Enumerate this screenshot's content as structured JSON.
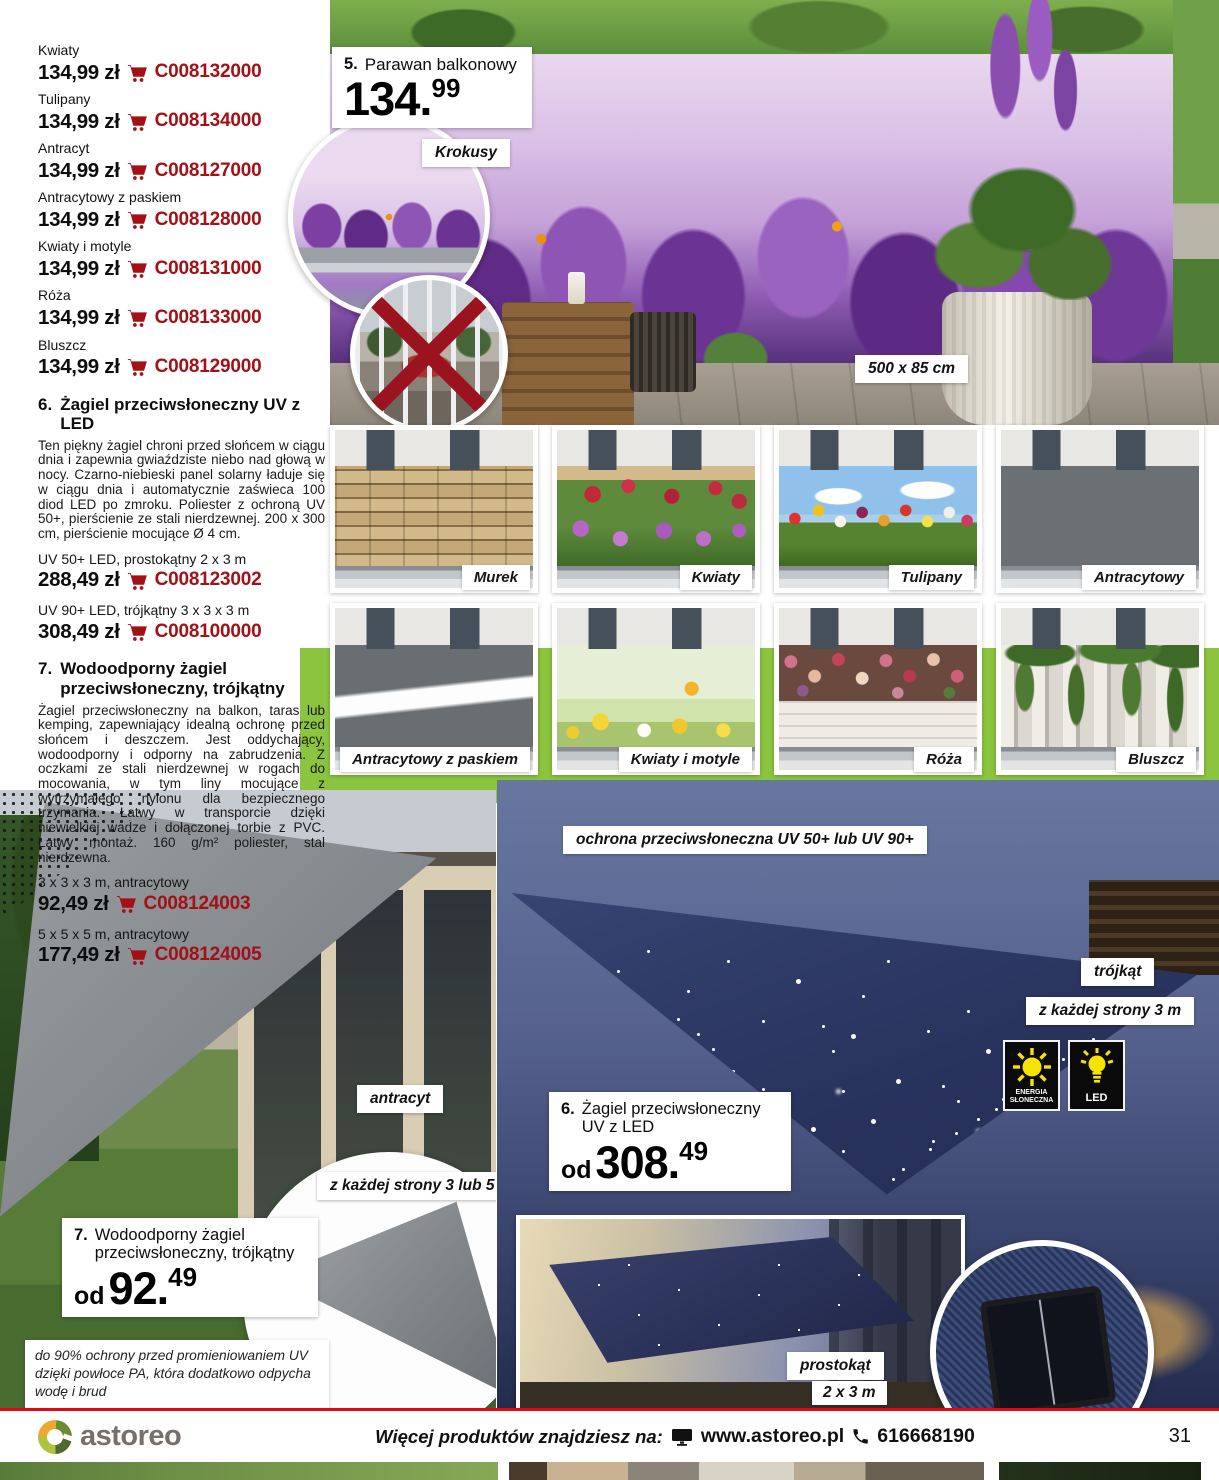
{
  "colors": {
    "accent_red": "#a31016",
    "footer_line": "#e30613",
    "green_band": "#8bc53f"
  },
  "icons": {
    "cart": "cart-icon",
    "sun": "sun-icon",
    "bulb": "bulb-icon",
    "monitor": "monitor-icon",
    "phone": "phone-icon",
    "red_x": "red-x-icon"
  },
  "price_list": [
    {
      "label": "Kwiaty",
      "price": "134,99 zł",
      "code": "C008132000"
    },
    {
      "label": "Tulipany",
      "price": "134,99 zł",
      "code": "C008134000"
    },
    {
      "label": "Antracyt",
      "price": "134,99 zł",
      "code": "C008127000"
    },
    {
      "label": "Antracytowy z paskiem",
      "price": "134,99 zł",
      "code": "C008128000"
    },
    {
      "label": "Kwiaty i motyle",
      "price": "134,99 zł",
      "code": "C008131000"
    },
    {
      "label": "Róża",
      "price": "134,99 zł",
      "code": "C008133000"
    },
    {
      "label": "Bluszcz",
      "price": "134,99 zł",
      "code": "C008129000"
    }
  ],
  "hero": {
    "number": "5.",
    "title": "Parawan balkonowy",
    "price_int": "134.",
    "price_frac": "99",
    "variant_label": "Krokusy",
    "size_label": "500 x 85 cm"
  },
  "product6": {
    "number": "6.",
    "title": "Żagiel przeciwsłoneczny UV z LED",
    "description": "Ten piękny żagiel chroni przed słońcem w ciągu dnia i zapewnia gwiaździste niebo nad głową w nocy. Czarno-niebieski panel solarny ładuje się w ciągu dnia i automatycznie zaświeca 100 diod LED po zmroku. Poliester z ochroną UV 50+, pierścienie ze stali nierdzewnej. 200 x 300 cm, pierścienie mocujące Ø 4 cm.",
    "variants": [
      {
        "label": "UV 50+ LED, prostokątny 2 x 3 m",
        "price": "288,49 zł",
        "code": "C008123002"
      },
      {
        "label": "UV 90+ LED, trójkątny 3 x 3 x 3 m",
        "price": "308,49 zł",
        "code": "C008100000"
      }
    ],
    "photo": {
      "uv_label": "ochrona przeciwsłoneczna UV 50+ lub UV 90+",
      "shape_label": "trójkąt",
      "side_label": "z każdej strony 3 m",
      "badge_solar": "ENERGIA SŁONECZNA",
      "badge_led": "LED",
      "price_prefix": "od",
      "price_int": "308.",
      "price_frac": "49",
      "inner_shape_label": "prostokąt",
      "inner_size_label": "2 x 3 m"
    }
  },
  "product7": {
    "number": "7.",
    "title": "Wodoodporny żagiel przeciwsłoneczny, trójkątny",
    "description": "Żagiel przeciwsłoneczny na balkon, taras lub kemping, zapewniający idealną ochronę przed słońcem i deszczem. Jest oddychający, wodoodporny i odporny na zabrudzenia. Z oczkami ze stali nierdzewnej w rogach do mocowania, w tym liny mocujące z wytrzymałego nylonu dla bezpiecznego trzymania. Łatwy w transporcie dzięki niewielkiej wadze i dołączonej torbie z PVC. Łatwy montaż. 160 g/m² poliester, stal nierdzewna.",
    "variants": [
      {
        "label": "3 x 3 x 3 m, antracytowy",
        "price": "92,49 zł",
        "code": "C008124003"
      },
      {
        "label": "5 x 5 x 5 m, antracytowy",
        "price": "177,49 zł",
        "code": "C008124005"
      }
    ],
    "photo": {
      "color_label": "antracyt",
      "side_label": "z każdej strony 3 lub 5 m",
      "price_prefix": "od",
      "price_int": "92.",
      "price_frac": "49",
      "footnote": "do 90% ochrony przed promieniowaniem UV dzięki powłoce PA, która dodatkowo odpycha wodę i brud"
    }
  },
  "thumbnails": [
    {
      "label": "Murek"
    },
    {
      "label": "Kwiaty"
    },
    {
      "label": "Tulipany"
    },
    {
      "label": "Antracytowy"
    },
    {
      "label": "Antracytowy z paskiem"
    },
    {
      "label": "Kwiaty i motyle"
    },
    {
      "label": "Róża"
    },
    {
      "label": "Bluszcz"
    }
  ],
  "footer": {
    "brand": "astoreo",
    "more_text": "Więcej produktów znajdziesz na:",
    "website": "www.astoreo.pl",
    "phone": "616668190",
    "page_number": "31"
  }
}
